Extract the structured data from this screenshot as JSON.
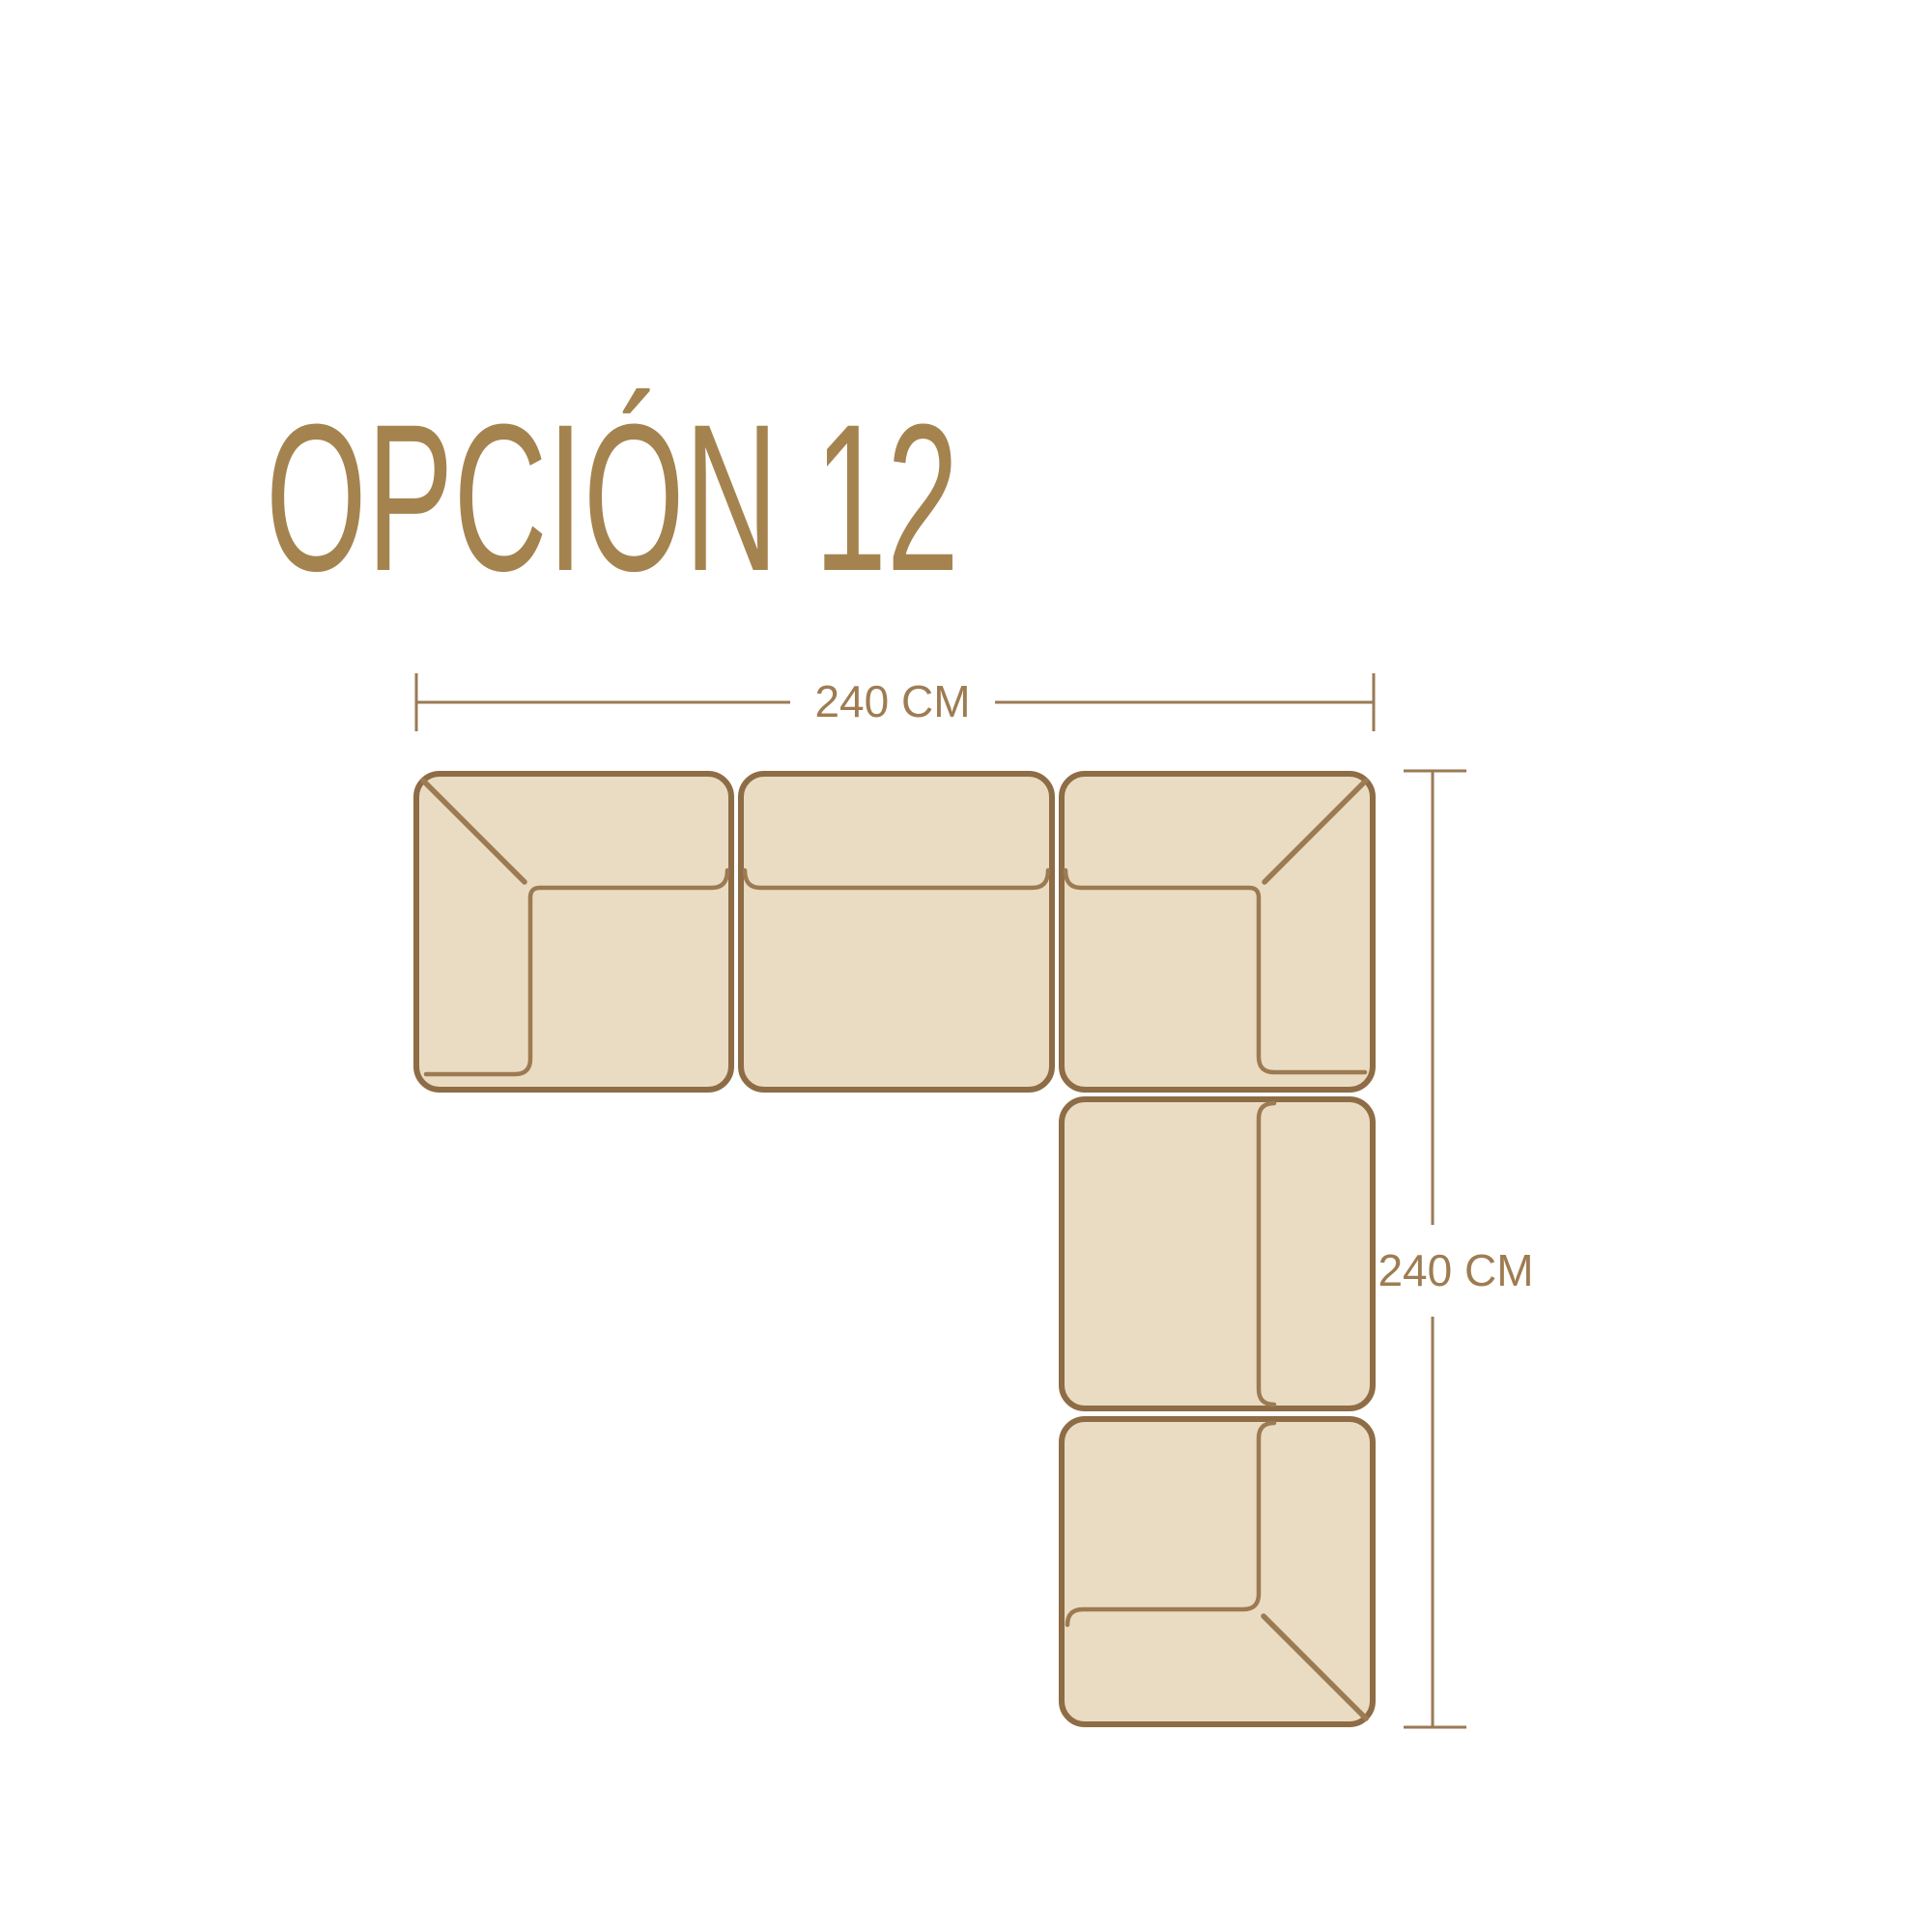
{
  "title": {
    "text": "OPCIÓN 12"
  },
  "diagram": {
    "type": "sectional-sofa-top-view-floorplan",
    "width_dimension": {
      "label": "240 CM",
      "value_cm": 240
    },
    "height_dimension": {
      "label": "240 CM",
      "value_cm": 240
    },
    "modules": [
      "corner-module-top-left",
      "center-module-top",
      "corner-module-top-right",
      "middle-module-right",
      "corner-module-bottom-right"
    ]
  },
  "colors": {
    "canvas": "#FFFFFF",
    "sofa_fill": "#E9DCC3",
    "sofa_outline": "#8E6C45",
    "sofa_inner_line": "#9C7A52",
    "dimension_line": "#9A7A55",
    "dimension_text": "#9E7C52",
    "title_text": "#A5834F"
  }
}
